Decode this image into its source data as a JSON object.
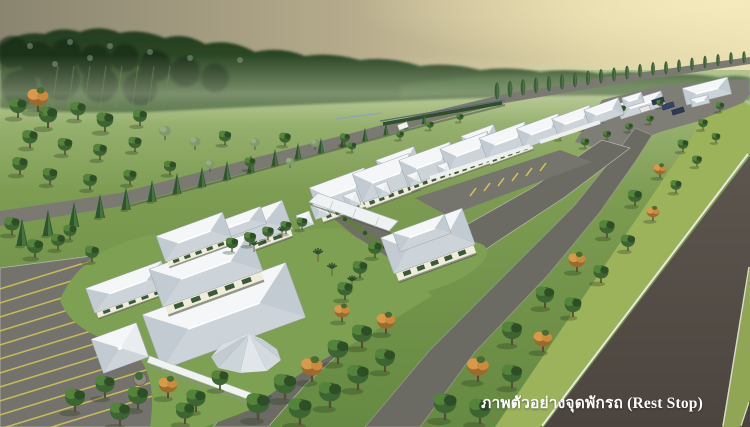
{
  "caption": {
    "text": "ภาพตัวอย่างจุดพักรถ (Rest Stop)"
  },
  "palette": {
    "sky_left": "#8a8570",
    "sky_right": "#e8ddae",
    "forest_dark": "#22391e",
    "forest_light": "#4f7340",
    "meadow": "#7d9c52",
    "lawn": "#7da052",
    "road_gray": "#6b6a63",
    "highway_asphalt": "#564e48",
    "median_grass": "#90a654",
    "verge_grass": "#9cb35c",
    "white_line": "#e9e9e0",
    "roof_white": "#eceef0",
    "roof_shade": "#ccd4da",
    "wall_cream": "#efecdc",
    "window_green": "#3c5a38",
    "tree_green": "#3d6531",
    "orange_tree": "#cc8a3c",
    "parking_stripe": "#d2c352",
    "caption_color": "#ffffff"
  }
}
